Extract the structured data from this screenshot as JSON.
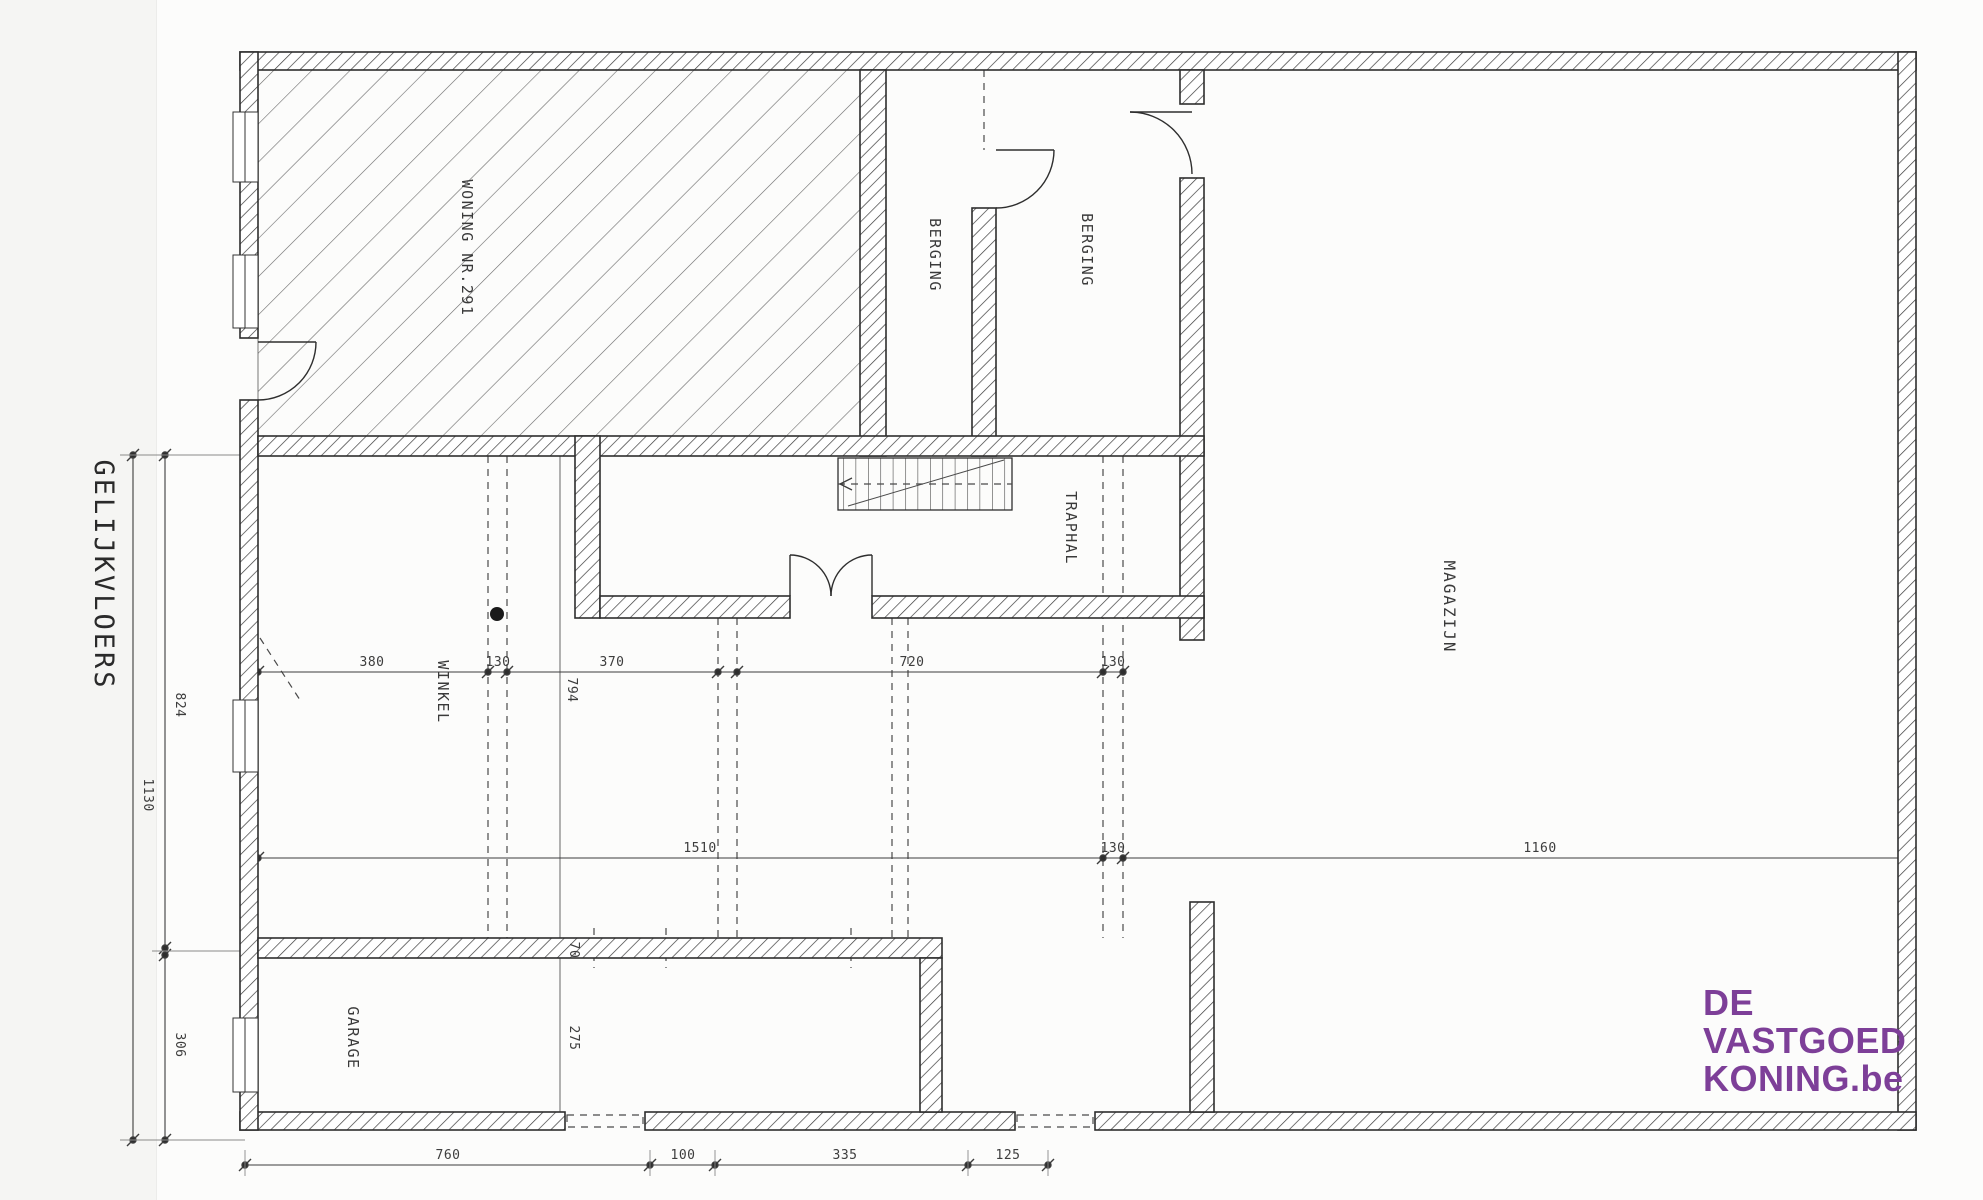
{
  "page": {
    "paper_color": "#fcfcfb",
    "line_color": "#2e2e2e"
  },
  "plan": {
    "title": "GELIJKVLOERS",
    "rooms": {
      "woning": {
        "label": "WONING NR.291"
      },
      "berging_left": {
        "label": "BERGING"
      },
      "berging_right": {
        "label": "BERGING"
      },
      "traphal": {
        "label": "TRAPHAL"
      },
      "magazijn": {
        "label": "MAGAZIJN"
      },
      "winkel": {
        "label": "WINKEL"
      },
      "garage": {
        "label": "GARAGE"
      }
    },
    "dimensions": {
      "top_chain": {
        "seg1": "380",
        "seg2": "130",
        "seg3": "370",
        "seg4": "720",
        "seg5": "130"
      },
      "winkel_depth": "794",
      "middle_chain": {
        "seg1": "1510",
        "seg2": "130",
        "seg3": "1160"
      },
      "bottom_chain": {
        "seg1": "760",
        "seg2": "100",
        "seg3": "335",
        "seg4": "125"
      },
      "left_total": "1130",
      "left_upper": "824",
      "left_lower": "306",
      "garage_wall": "70",
      "garage_depth": "275"
    }
  },
  "watermark": {
    "line1": "DE",
    "line2": "VASTGOED",
    "line3": "KONING.be",
    "color": "#7d3f98"
  }
}
